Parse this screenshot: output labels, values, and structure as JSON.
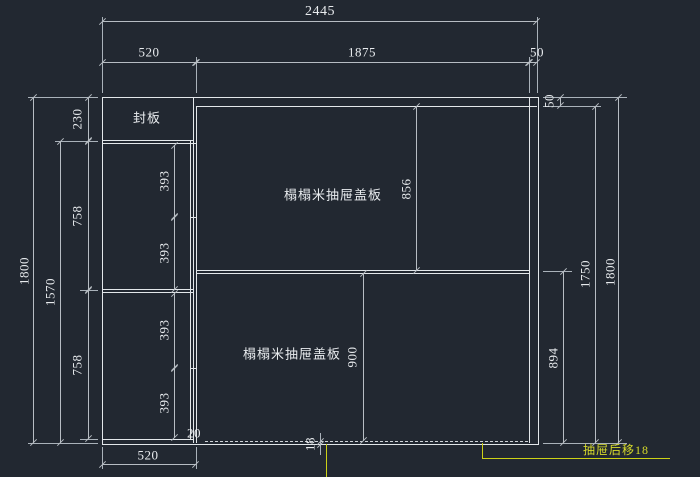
{
  "drawing": {
    "type": "cad-dimension-drawing",
    "background_color": "#222831",
    "geometry_line_color": "#e3e7ea",
    "dimension_line_color": "#b7bdc3",
    "highlight_color": "#ccd117"
  },
  "labels": {
    "seal_plate": "封板",
    "upper_panel": "榻榻米抽屉盖板",
    "lower_panel": "榻榻米抽屉盖板",
    "drawer_note": "抽屉后移18"
  },
  "dimensions": {
    "top_total": "2445",
    "top_left": "520",
    "top_middle": "1875",
    "top_right": "50",
    "right_rail": "50",
    "upper_panel_height": "856",
    "lower_panel_height": "900",
    "right_lower": "894",
    "right_inner": "1750",
    "right_total": "1800",
    "left_total": "1800",
    "left_lower_span": "1570",
    "seal_plate_height": "230",
    "left_upper": "758",
    "left_lower": "758",
    "col_393_1": "393",
    "col_393_2": "393",
    "col_393_3": "393",
    "col_393_4": "393",
    "gap_20": "20",
    "setback_18": "18",
    "bottom_width": "520"
  }
}
